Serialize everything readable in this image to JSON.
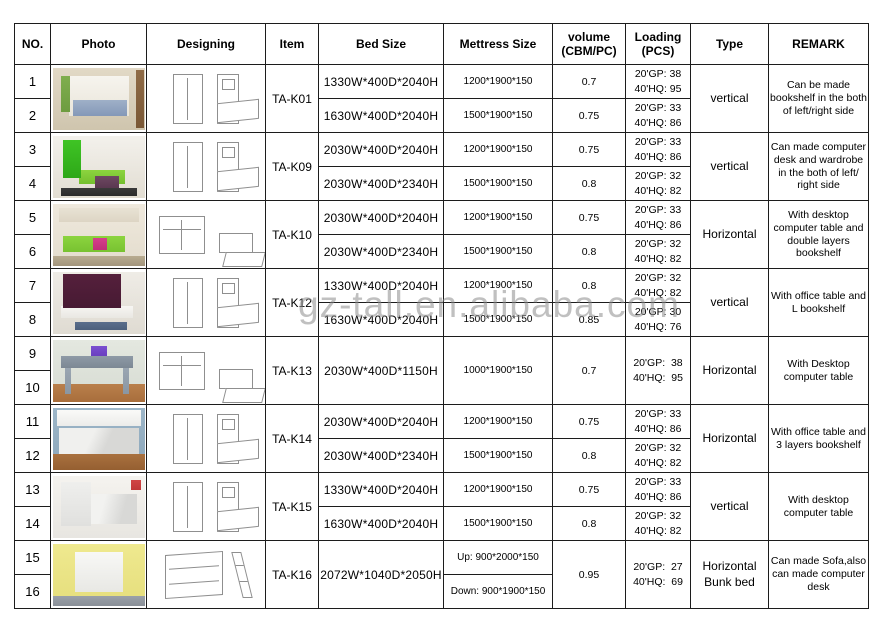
{
  "watermark": {
    "text": "gz-tall.en.alibaba.com",
    "color": "#8e8e8e"
  },
  "table": {
    "headers": {
      "no": "NO.",
      "photo": "Photo",
      "designing": "Designing",
      "item": "Item",
      "bed_size": "Bed Size",
      "mattress_size": "Mettress Size",
      "volume_1": "volume",
      "volume_2": "(CBM/PC)",
      "loading_1": "Loading",
      "loading_2": "(PCS)",
      "type": "Type",
      "remark": "REMARK"
    },
    "groups": [
      {
        "rows": [
          "1",
          "2"
        ],
        "item": "TA-K01",
        "bed_sizes": [
          "1330W*400D*2040H",
          "1630W*400D*2040H"
        ],
        "mattress_sizes": [
          "1200*1900*150",
          "1500*1900*150"
        ],
        "volumes": [
          "0.7",
          "0.75"
        ],
        "loadings": [
          [
            "20'GP: 38",
            "40'HQ: 95"
          ],
          [
            "20'GP: 33",
            "40'HQ: 86"
          ]
        ],
        "type": [
          "vertical"
        ],
        "remark": "Can be made bookshelf in the both of left/right side",
        "photo_desc": "bedroom with open vertical wall bed, blue bedding, brown curtain"
      },
      {
        "rows": [
          "3",
          "4"
        ],
        "item": "TA-K09",
        "bed_sizes": [
          "2030W*400D*2040H",
          "2030W*400D*2340H"
        ],
        "mattress_sizes": [
          "1200*1900*150",
          "1500*1900*150"
        ],
        "volumes": [
          "0.75",
          "0.8"
        ],
        "loadings": [
          [
            "20'GP: 33",
            "40'HQ: 86"
          ],
          [
            "20'GP: 32",
            "40'HQ: 82"
          ]
        ],
        "type": [
          "vertical"
        ],
        "remark": "Can made computer desk and wardrobe  in the both of left/ right side",
        "photo_desc": "green wall-bed cabinet with green sofa and purple throw"
      },
      {
        "rows": [
          "5",
          "6"
        ],
        "item": "TA-K10",
        "bed_sizes": [
          "2030W*400D*2040H",
          "2030W*400D*2340H"
        ],
        "mattress_sizes": [
          "1200*1900*150",
          "1500*1900*150"
        ],
        "volumes": [
          "0.75",
          "0.8"
        ],
        "loadings": [
          [
            "20'GP: 33",
            "40'HQ: 86"
          ],
          [
            "20'GP: 32",
            "40'HQ: 82"
          ]
        ],
        "type": [
          "Horizontal"
        ],
        "remark": "With desktop computer table and double layers bookshelf",
        "photo_desc": "horizontal wall bed with bookshelf above, green and pink sofa"
      },
      {
        "rows": [
          "7",
          "8"
        ],
        "item": "TA-K12",
        "bed_sizes": [
          "1330W*400D*2040H",
          "1630W*400D*2040H"
        ],
        "mattress_sizes": [
          "1200*1900*150",
          "1500*1900*150"
        ],
        "volumes": [
          "0.8",
          "0.85"
        ],
        "loadings": [
          [
            "20'GP: 32",
            "40'HQ: 82"
          ],
          [
            "20'GP: 30",
            "40'HQ: 76"
          ]
        ],
        "type": [
          "vertical"
        ],
        "remark": "With office table and L bookshelf",
        "photo_desc": "dark maroon wall unit with white office table and blue rug"
      },
      {
        "rows": [
          "9",
          "10"
        ],
        "item": "TA-K13",
        "bed_sizes": [
          "2030W*400D*1150H"
        ],
        "mattress_sizes": [
          "1000*1900*150"
        ],
        "volumes": [
          "0.7"
        ],
        "loadings": [
          [
            "20'GP:  38",
            "40'HQ:  95"
          ]
        ],
        "type": [
          "Horizontal"
        ],
        "remark": "With Desktop computer table",
        "photo_desc": "gray-blue console desk with laptop on wooden floor"
      },
      {
        "rows": [
          "11",
          "12"
        ],
        "item": "TA-K14",
        "bed_sizes": [
          "2030W*400D*2040H",
          "2030W*400D*2340H"
        ],
        "mattress_sizes": [
          "1200*1900*150",
          "1500*1900*150"
        ],
        "volumes": [
          "0.75",
          "0.8"
        ],
        "loadings": [
          [
            "20'GP: 33",
            "40'HQ: 86"
          ],
          [
            "20'GP: 32",
            "40'HQ: 82"
          ]
        ],
        "type": [
          "Horizontal"
        ],
        "remark": "With office table and 3 layers bookshelf",
        "photo_desc": "white horizontal fold-down bed opening over wooden floor"
      },
      {
        "rows": [
          "13",
          "14"
        ],
        "item": "TA-K15",
        "bed_sizes": [
          "1330W*400D*2040H",
          "1630W*400D*2040H"
        ],
        "mattress_sizes": [
          "1200*1900*150",
          "1500*1900*150"
        ],
        "volumes": [
          "0.75",
          "0.8"
        ],
        "loadings": [
          [
            "20'GP: 33",
            "40'HQ: 86"
          ],
          [
            "20'GP: 32",
            "40'HQ: 82"
          ]
        ],
        "type": [
          "vertical"
        ],
        "remark": "With desktop computer table",
        "photo_desc": "white vertical wall bed half folded with desk below, flowers"
      },
      {
        "rows": [
          "15",
          "16"
        ],
        "item": "TA-K16",
        "bed_sizes": [
          "2072W*1040D*2050H"
        ],
        "mattress_sizes": [
          "Up: 900*2000*150",
          "Down: 900*1900*150"
        ],
        "volumes": [
          "0.95"
        ],
        "loadings": [
          [
            "20'GP:  27",
            "40'HQ:  69"
          ]
        ],
        "type": [
          "Horizontal",
          "Bunk bed"
        ],
        "remark": "Can made Sofa,also can made computer desk",
        "photo_desc": "bunk wall bed in yellow room with desk and ladder"
      }
    ]
  }
}
